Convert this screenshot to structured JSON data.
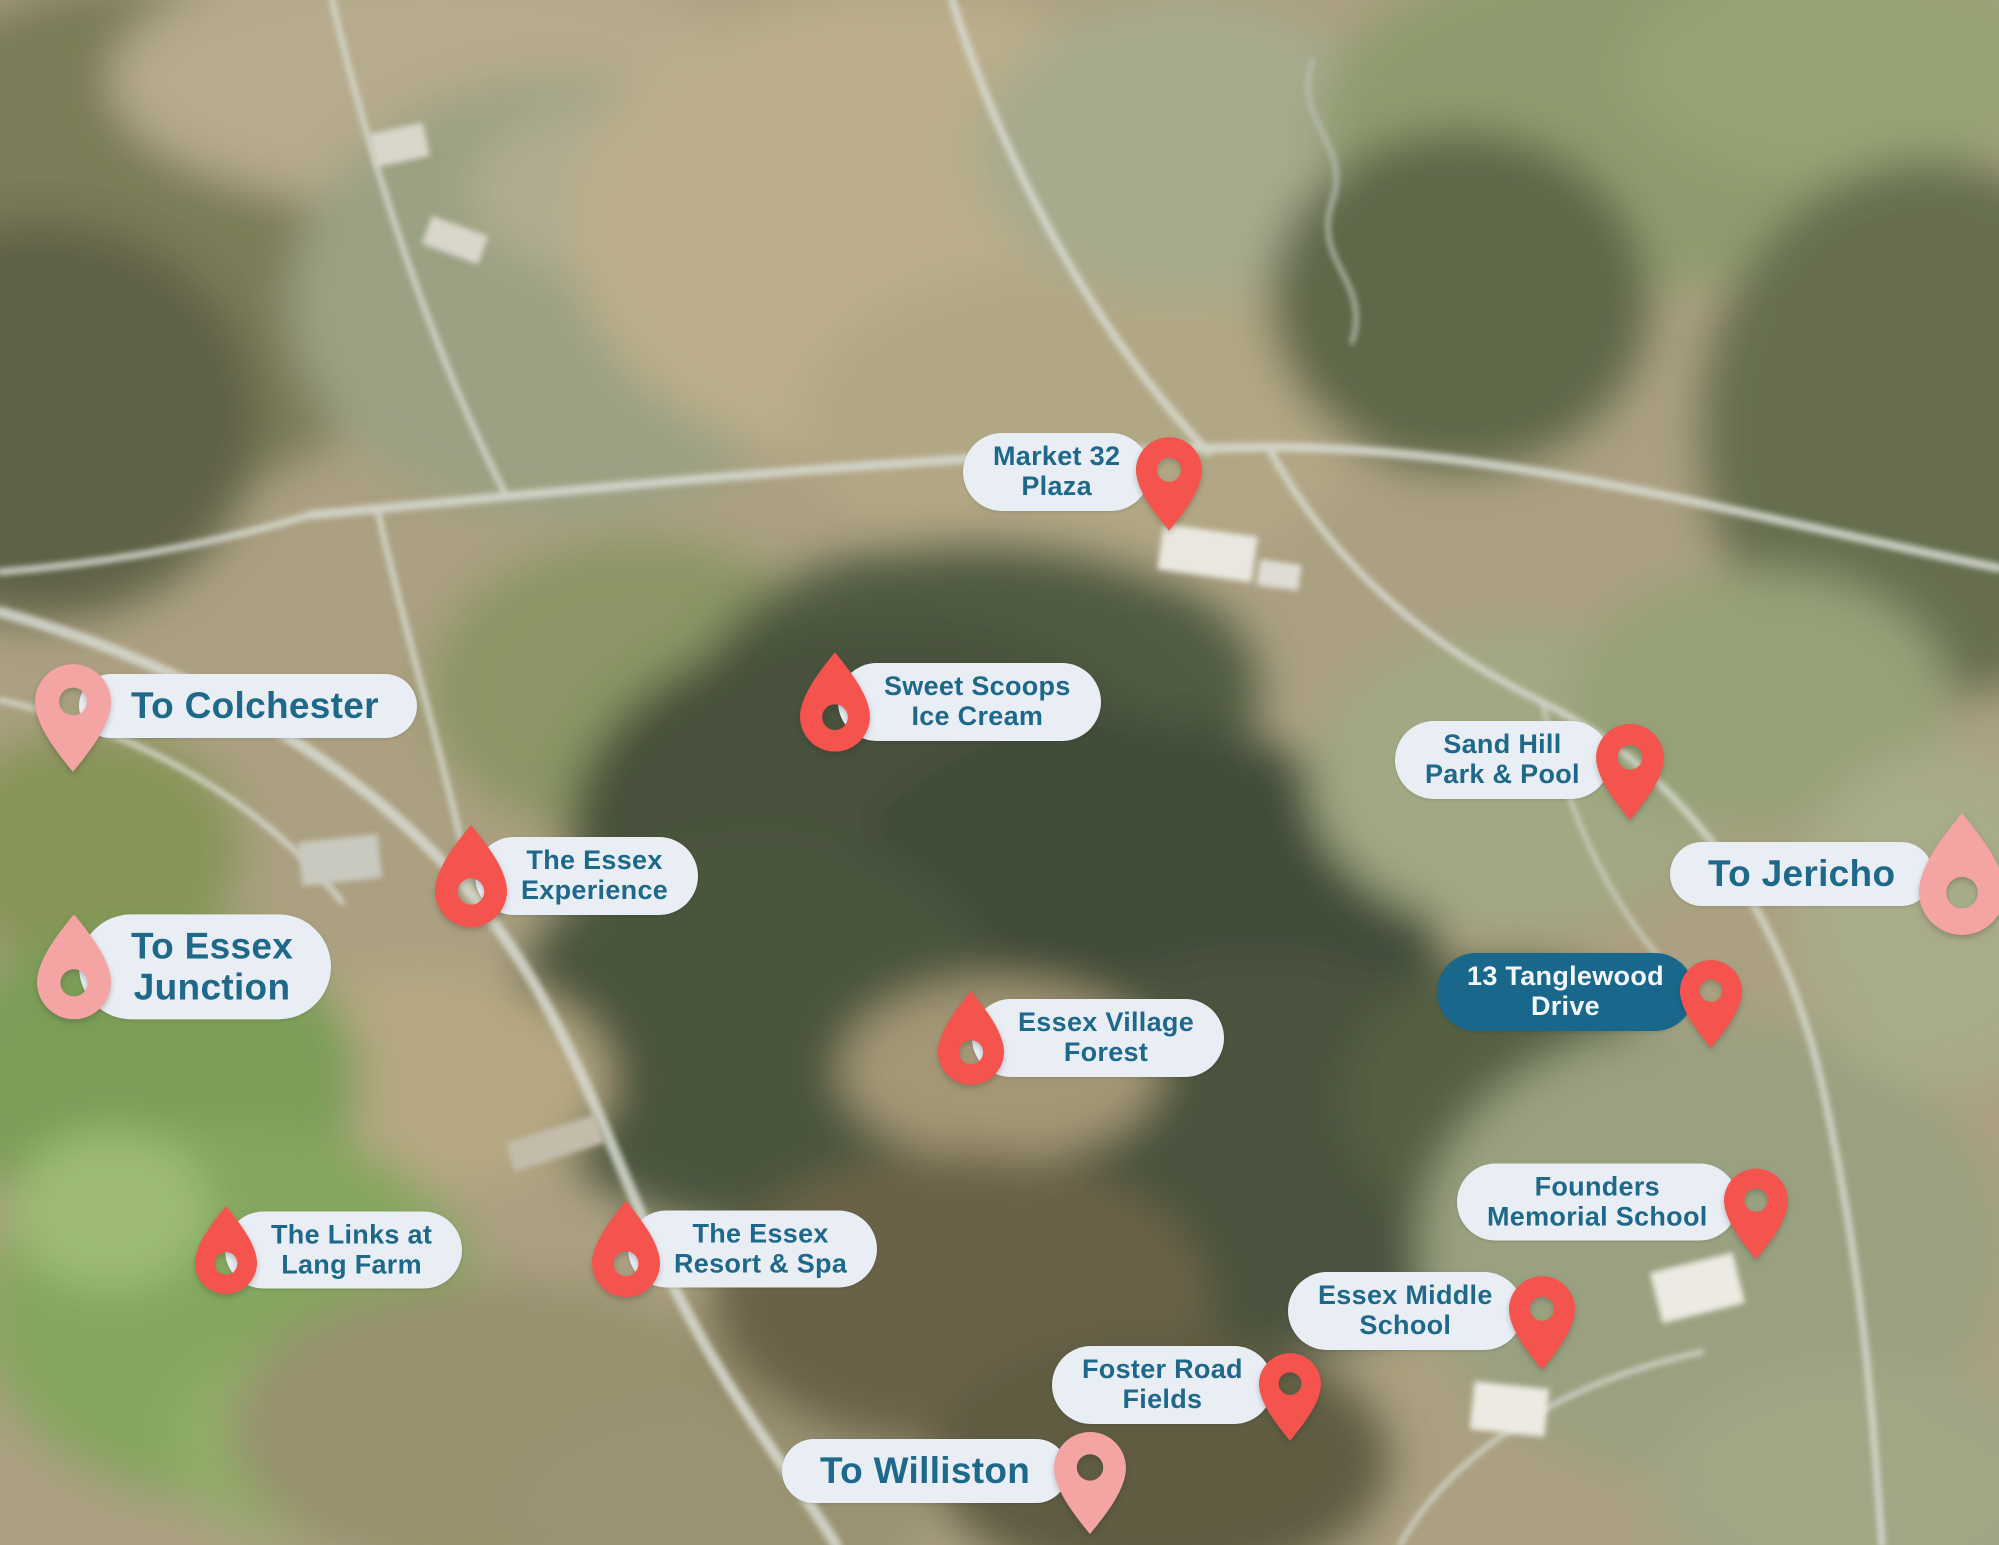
{
  "map": {
    "description": "Aerial satellite map of Essex, Vermont with labeled location pins",
    "colors": {
      "pin_red": "#f4534e",
      "pin_pink": "#f4a4a3",
      "pill_bg": "#e9eef5",
      "pill_text": "#1e6889",
      "dark_pill_bg": "#19688c",
      "dark_pill_text": "#f2f6f8"
    },
    "markers": [
      {
        "id": "to-colchester",
        "lines": [
          "To Colchester"
        ],
        "variant": "gateway",
        "pin": {
          "shape": "classic",
          "color": "pink",
          "side": "left"
        },
        "pin_w": 76,
        "pin_h": 108,
        "x": 35,
        "cy": 706
      },
      {
        "id": "market-32-plaza",
        "lines": [
          "Market 32",
          "Plaza"
        ],
        "variant": "light",
        "pin": {
          "shape": "classic",
          "color": "red",
          "side": "right"
        },
        "pin_w": 66,
        "pin_h": 94,
        "x": 963,
        "cy": 472
      },
      {
        "id": "sweet-scoops-ice-cream",
        "lines": [
          "Sweet Scoops",
          "Ice Cream"
        ],
        "variant": "light",
        "pin": {
          "shape": "drop",
          "color": "red",
          "side": "left"
        },
        "pin_w": 70,
        "pin_h": 100,
        "x": 800,
        "cy": 702
      },
      {
        "id": "sand-hill-park-pool",
        "lines": [
          "Sand Hill",
          "Park & Pool"
        ],
        "variant": "light",
        "pin": {
          "shape": "classic",
          "color": "red",
          "side": "right"
        },
        "pin_w": 68,
        "pin_h": 96,
        "x": 1395,
        "cy": 760
      },
      {
        "id": "to-jericho",
        "lines": [
          "To Jericho"
        ],
        "variant": "gateway",
        "pin": {
          "shape": "drop",
          "color": "pink",
          "side": "right"
        },
        "pin_w": 86,
        "pin_h": 122,
        "x": 1670,
        "cy": 874
      },
      {
        "id": "the-essex-experience",
        "lines": [
          "The Essex",
          "Experience"
        ],
        "variant": "light",
        "pin": {
          "shape": "drop",
          "color": "red",
          "side": "left"
        },
        "pin_w": 72,
        "pin_h": 102,
        "x": 435,
        "cy": 876
      },
      {
        "id": "to-essex-junction",
        "lines": [
          "To Essex",
          "Junction"
        ],
        "variant": "gateway",
        "pin": {
          "shape": "drop",
          "color": "pink",
          "side": "left"
        },
        "pin_w": 74,
        "pin_h": 105,
        "x": 37,
        "cy": 967
      },
      {
        "id": "13-tanglewood-drive",
        "lines": [
          "13 Tanglewood",
          "Drive"
        ],
        "variant": "dark",
        "pin": {
          "shape": "classic",
          "color": "red",
          "side": "right"
        },
        "pin_w": 62,
        "pin_h": 88,
        "x": 1437,
        "cy": 992
      },
      {
        "id": "essex-village-forest",
        "lines": [
          "Essex Village",
          "Forest"
        ],
        "variant": "light",
        "pin": {
          "shape": "drop",
          "color": "red",
          "side": "left"
        },
        "pin_w": 66,
        "pin_h": 94,
        "x": 938,
        "cy": 1038
      },
      {
        "id": "founders-memorial-school",
        "lines": [
          "Founders",
          "Memorial School"
        ],
        "variant": "light",
        "pin": {
          "shape": "classic",
          "color": "red",
          "side": "right"
        },
        "pin_w": 64,
        "pin_h": 91,
        "x": 1457,
        "cy": 1202
      },
      {
        "id": "the-links-at-lang-farm",
        "lines": [
          "The Links at",
          "Lang Farm"
        ],
        "variant": "light",
        "pin": {
          "shape": "drop",
          "color": "red",
          "side": "left"
        },
        "pin_w": 62,
        "pin_h": 95,
        "x": 195,
        "cy": 1250
      },
      {
        "id": "the-essex-resort-spa",
        "lines": [
          "The Essex",
          "Resort & Spa"
        ],
        "variant": "light",
        "pin": {
          "shape": "drop",
          "color": "red",
          "side": "left"
        },
        "pin_w": 68,
        "pin_h": 97,
        "x": 592,
        "cy": 1249
      },
      {
        "id": "essex-middle-school",
        "lines": [
          "Essex Middle",
          "School"
        ],
        "variant": "light",
        "pin": {
          "shape": "classic",
          "color": "red",
          "side": "right"
        },
        "pin_w": 66,
        "pin_h": 94,
        "x": 1288,
        "cy": 1311
      },
      {
        "id": "foster-road-fields",
        "lines": [
          "Foster Road",
          "Fields"
        ],
        "variant": "light",
        "pin": {
          "shape": "classic",
          "color": "red",
          "side": "right"
        },
        "pin_w": 62,
        "pin_h": 88,
        "x": 1052,
        "cy": 1385
      },
      {
        "id": "to-williston",
        "lines": [
          "To Williston"
        ],
        "variant": "gateway",
        "pin": {
          "shape": "classic",
          "color": "pink",
          "side": "right"
        },
        "pin_w": 72,
        "pin_h": 102,
        "x": 782,
        "cy": 1471
      }
    ]
  }
}
